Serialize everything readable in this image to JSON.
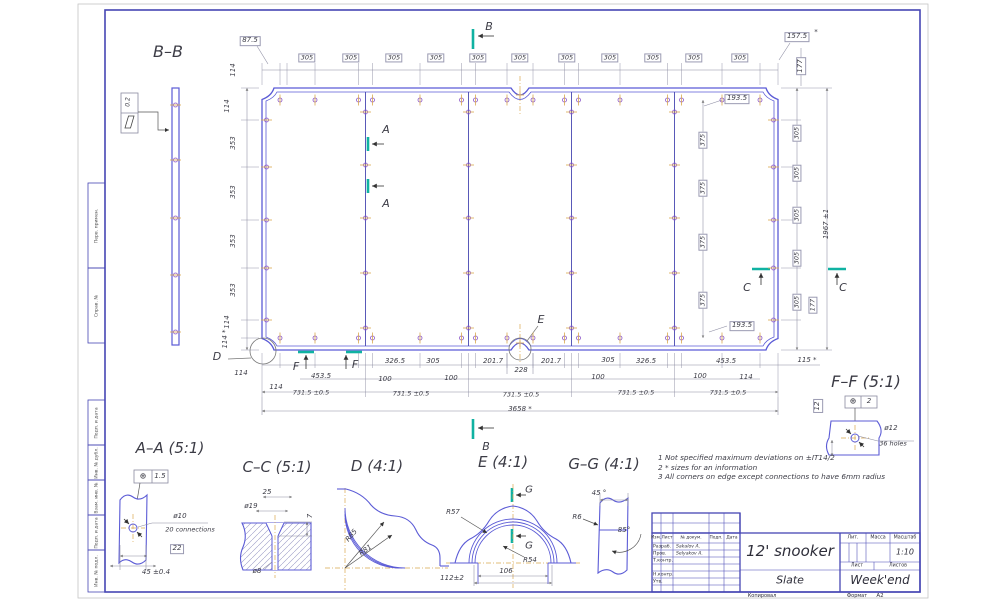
{
  "drawing": {
    "title": "12' snooker",
    "material": "Slate",
    "company": "Week'end",
    "scale": "1:10",
    "format": "A2",
    "hole_spec_main": "ø12 / 36 holes",
    "overall_length": "3658 *",
    "overall_width": "1967 ±1",
    "segment_pitch": "731.5 ±0.5"
  },
  "colors": {
    "line_blue": "#5b5bd6",
    "frame_blue": "#4646b4",
    "dim_gray": "#8a8aa0",
    "text": "#3c3c46",
    "section_teal": "#10b2a2",
    "centerline_gold": "#d9a84f",
    "bolt_purple": "#8a55c8"
  },
  "notes": [
    "1  Not specified maximum deviations on ±IT14/2",
    "2  * sizes for an information",
    "3  All corners on edge except connections to have 6mm radius"
  ],
  "margin_stamps": [
    "Перв. примен.",
    "Справ. №",
    "Подп. и дата",
    "Инв. № дубл.",
    "Взам. инв. №",
    "Подп. и дата",
    "Инв. № подл."
  ],
  "title_block": {
    "title": "12' snooker",
    "material": "Slate",
    "company": "Week'end",
    "scale": "1:10",
    "headers": {
      "izm": "Изм.",
      "list": "Лист",
      "doc": "№ докум.",
      "podp": "Подп.",
      "data": "Дата",
      "lit": "Лит.",
      "massa": "Масса",
      "masshtab": "Масштаб",
      "sheet": "Лист",
      "sheets": "Листов"
    },
    "rows": [
      {
        "role": "Разраб.",
        "name": "Sakalov A."
      },
      {
        "role": "Пров.",
        "name": "Selyakov A."
      },
      {
        "role": "Т.контр.",
        "name": ""
      },
      {
        "role": "Н.контр.",
        "name": ""
      },
      {
        "role": "Утв.",
        "name": ""
      }
    ],
    "footer": {
      "copy": "Копировал",
      "format_label": "Формат",
      "format_value": "A2"
    }
  },
  "labels": [
    {
      "t": "B–B",
      "x": 168,
      "y": 52,
      "s": 16,
      "n": "view-title-bb"
    },
    {
      "t": "A–A (5:1)",
      "x": 170,
      "y": 448,
      "s": 15,
      "n": "view-title-aa"
    },
    {
      "t": "C–C (5:1)",
      "x": 277,
      "y": 467,
      "s": 15,
      "n": "view-title-cc"
    },
    {
      "t": "D (4:1)",
      "x": 377,
      "y": 466,
      "s": 15,
      "n": "view-title-d"
    },
    {
      "t": "E (4:1)",
      "x": 503,
      "y": 462,
      "s": 15,
      "n": "view-title-e"
    },
    {
      "t": "G–G (4:1)",
      "x": 604,
      "y": 464,
      "s": 15,
      "n": "view-title-gg"
    },
    {
      "t": "F–F (5:1)",
      "x": 866,
      "y": 382,
      "s": 16,
      "n": "view-title-ff"
    },
    {
      "t": "B",
      "x": 489,
      "y": 27,
      "s": 11,
      "n": "section-letter"
    },
    {
      "t": "B",
      "x": 486,
      "y": 447,
      "s": 11,
      "n": "section-letter"
    },
    {
      "t": "A",
      "x": 386,
      "y": 130,
      "s": 11,
      "n": "section-letter"
    },
    {
      "t": "A",
      "x": 386,
      "y": 204,
      "s": 11,
      "n": "section-letter"
    },
    {
      "t": "C",
      "x": 747,
      "y": 288,
      "s": 11,
      "n": "section-letter"
    },
    {
      "t": "C",
      "x": 843,
      "y": 288,
      "s": 11,
      "n": "section-letter"
    },
    {
      "t": "F",
      "x": 296,
      "y": 367,
      "s": 11,
      "n": "section-letter"
    },
    {
      "t": "F",
      "x": 355,
      "y": 365,
      "s": 11,
      "n": "section-letter"
    },
    {
      "t": "D",
      "x": 217,
      "y": 357,
      "s": 11,
      "n": "detail-letter"
    },
    {
      "t": "E",
      "x": 541,
      "y": 320,
      "s": 11,
      "n": "detail-letter"
    },
    {
      "t": "G",
      "x": 529,
      "y": 490,
      "s": 10,
      "n": "section-letter"
    },
    {
      "t": "G",
      "x": 529,
      "y": 546,
      "s": 10,
      "n": "section-letter"
    },
    {
      "t": "87.5",
      "x": 250,
      "y": 41,
      "b": 1
    },
    {
      "t": "305",
      "x": 307,
      "y": 58,
      "b": 1,
      "s": 6.5
    },
    {
      "t": "305",
      "x": 351,
      "y": 58,
      "b": 1,
      "s": 6.5
    },
    {
      "t": "305",
      "x": 394,
      "y": 58,
      "b": 1,
      "s": 6.5
    },
    {
      "t": "305",
      "x": 436,
      "y": 58,
      "b": 1,
      "s": 6.5
    },
    {
      "t": "305",
      "x": 478,
      "y": 58,
      "b": 1,
      "s": 6.5
    },
    {
      "t": "305",
      "x": 520,
      "y": 58,
      "b": 1,
      "s": 6.5
    },
    {
      "t": "305",
      "x": 567,
      "y": 58,
      "b": 1,
      "s": 6.5
    },
    {
      "t": "305",
      "x": 610,
      "y": 58,
      "b": 1,
      "s": 6.5
    },
    {
      "t": "305",
      "x": 653,
      "y": 58,
      "b": 1,
      "s": 6.5
    },
    {
      "t": "305",
      "x": 694,
      "y": 58,
      "b": 1,
      "s": 6.5
    },
    {
      "t": "305",
      "x": 740,
      "y": 58,
      "b": 1,
      "s": 6.5
    },
    {
      "t": "157.5",
      "x": 797,
      "y": 37,
      "b": 1
    },
    {
      "t": "*",
      "x": 816,
      "y": 33
    },
    {
      "t": "177",
      "x": 801,
      "y": 66,
      "b": 1,
      "r": -90
    },
    {
      "t": "193.5",
      "x": 737,
      "y": 99,
      "b": 1
    },
    {
      "t": "114",
      "x": 234,
      "y": 70,
      "r": -90
    },
    {
      "t": "114",
      "x": 228,
      "y": 106,
      "r": -90
    },
    {
      "t": "353",
      "x": 234,
      "y": 143,
      "r": -90
    },
    {
      "t": "353",
      "x": 234,
      "y": 192,
      "r": -90
    },
    {
      "t": "353",
      "x": 234,
      "y": 241,
      "r": -90
    },
    {
      "t": "353",
      "x": 234,
      "y": 290,
      "r": -90
    },
    {
      "t": "114",
      "x": 228,
      "y": 322,
      "r": -90
    },
    {
      "t": "114 *",
      "x": 226,
      "y": 339,
      "r": -90
    },
    {
      "t": "375",
      "x": 703,
      "y": 140,
      "b": 1,
      "r": -90,
      "s": 6.5
    },
    {
      "t": "375",
      "x": 703,
      "y": 188,
      "b": 1,
      "r": -90,
      "s": 6.5
    },
    {
      "t": "375",
      "x": 703,
      "y": 242,
      "b": 1,
      "r": -90,
      "s": 6.5
    },
    {
      "t": "375",
      "x": 703,
      "y": 300,
      "b": 1,
      "r": -90,
      "s": 6.5
    },
    {
      "t": "305",
      "x": 797,
      "y": 133,
      "b": 1,
      "r": -90,
      "s": 6.5
    },
    {
      "t": "305",
      "x": 797,
      "y": 173,
      "b": 1,
      "r": -90,
      "s": 6.5
    },
    {
      "t": "305",
      "x": 797,
      "y": 215,
      "b": 1,
      "r": -90,
      "s": 6.5
    },
    {
      "t": "305",
      "x": 797,
      "y": 258,
      "b": 1,
      "r": -90,
      "s": 6.5
    },
    {
      "t": "305",
      "x": 797,
      "y": 302,
      "b": 1,
      "r": -90,
      "s": 6.5
    },
    {
      "t": "177",
      "x": 813,
      "y": 305,
      "b": 1,
      "r": -90,
      "s": 6.5
    },
    {
      "t": "1967 ±1",
      "x": 827,
      "y": 224,
      "r": -90
    },
    {
      "t": "193.5",
      "x": 742,
      "y": 326,
      "b": 1
    },
    {
      "t": "114",
      "x": 241,
      "y": 374
    },
    {
      "t": "114",
      "x": 276,
      "y": 388
    },
    {
      "t": "453.5",
      "x": 321,
      "y": 377
    },
    {
      "t": "326.5",
      "x": 395,
      "y": 362
    },
    {
      "t": "305",
      "x": 433,
      "y": 362
    },
    {
      "t": "100",
      "x": 385,
      "y": 380
    },
    {
      "t": "100",
      "x": 451,
      "y": 379
    },
    {
      "t": "201.7",
      "x": 493,
      "y": 362
    },
    {
      "t": "228",
      "x": 521,
      "y": 371
    },
    {
      "t": "201.7",
      "x": 551,
      "y": 362
    },
    {
      "t": "305",
      "x": 608,
      "y": 361
    },
    {
      "t": "326.5",
      "x": 646,
      "y": 362
    },
    {
      "t": "100",
      "x": 598,
      "y": 378
    },
    {
      "t": "100",
      "x": 700,
      "y": 377
    },
    {
      "t": "114",
      "x": 746,
      "y": 378
    },
    {
      "t": "453.5",
      "x": 726,
      "y": 362
    },
    {
      "t": "115 *",
      "x": 807,
      "y": 361
    },
    {
      "t": "731.5 ±0.5",
      "x": 311,
      "y": 393,
      "s": 6.5
    },
    {
      "t": "731.5 ±0.5",
      "x": 411,
      "y": 394,
      "s": 6.5
    },
    {
      "t": "731.5 ±0.5",
      "x": 521,
      "y": 395,
      "s": 6.5
    },
    {
      "t": "731.5 ±0.5",
      "x": 636,
      "y": 393,
      "s": 6.5
    },
    {
      "t": "731.5 ±0.5",
      "x": 728,
      "y": 393,
      "s": 6.5
    },
    {
      "t": "3658 *",
      "x": 520,
      "y": 410
    },
    {
      "t": "⊕",
      "x": 143,
      "y": 477,
      "s": 8
    },
    {
      "t": "1.5",
      "x": 160,
      "y": 477
    },
    {
      "t": "ø10",
      "x": 180,
      "y": 517
    },
    {
      "t": "20 connections",
      "x": 190,
      "y": 530,
      "s": 6.5
    },
    {
      "t": "22",
      "x": 177,
      "y": 549,
      "b": 1
    },
    {
      "t": "45 ±0.4",
      "x": 156,
      "y": 573
    },
    {
      "t": "25",
      "x": 267,
      "y": 493
    },
    {
      "t": "ø19",
      "x": 251,
      "y": 507
    },
    {
      "t": "7",
      "x": 311,
      "y": 516,
      "r": -90
    },
    {
      "t": "ø8",
      "x": 257,
      "y": 572
    },
    {
      "t": "R85",
      "x": 352,
      "y": 536,
      "r": -50
    },
    {
      "t": "R81",
      "x": 366,
      "y": 551,
      "r": -35
    },
    {
      "t": "R57",
      "x": 453,
      "y": 513
    },
    {
      "t": "R54",
      "x": 530,
      "y": 561
    },
    {
      "t": "106",
      "x": 506,
      "y": 572
    },
    {
      "t": "112±2",
      "x": 452,
      "y": 579
    },
    {
      "t": "45 °",
      "x": 599,
      "y": 494
    },
    {
      "t": "R6",
      "x": 577,
      "y": 518
    },
    {
      "t": "85°",
      "x": 624,
      "y": 531
    },
    {
      "t": "ø12",
      "x": 891,
      "y": 429
    },
    {
      "t": "36 holes",
      "x": 893,
      "y": 444,
      "s": 6.5
    },
    {
      "t": "12",
      "x": 818,
      "y": 406,
      "b": 1,
      "r": -90
    },
    {
      "t": "⊕",
      "x": 853,
      "y": 402,
      "s": 8
    },
    {
      "t": "2",
      "x": 869,
      "y": 402
    },
    {
      "t": "0.2",
      "x": 129,
      "y": 102,
      "r": -90,
      "s": 6
    }
  ]
}
